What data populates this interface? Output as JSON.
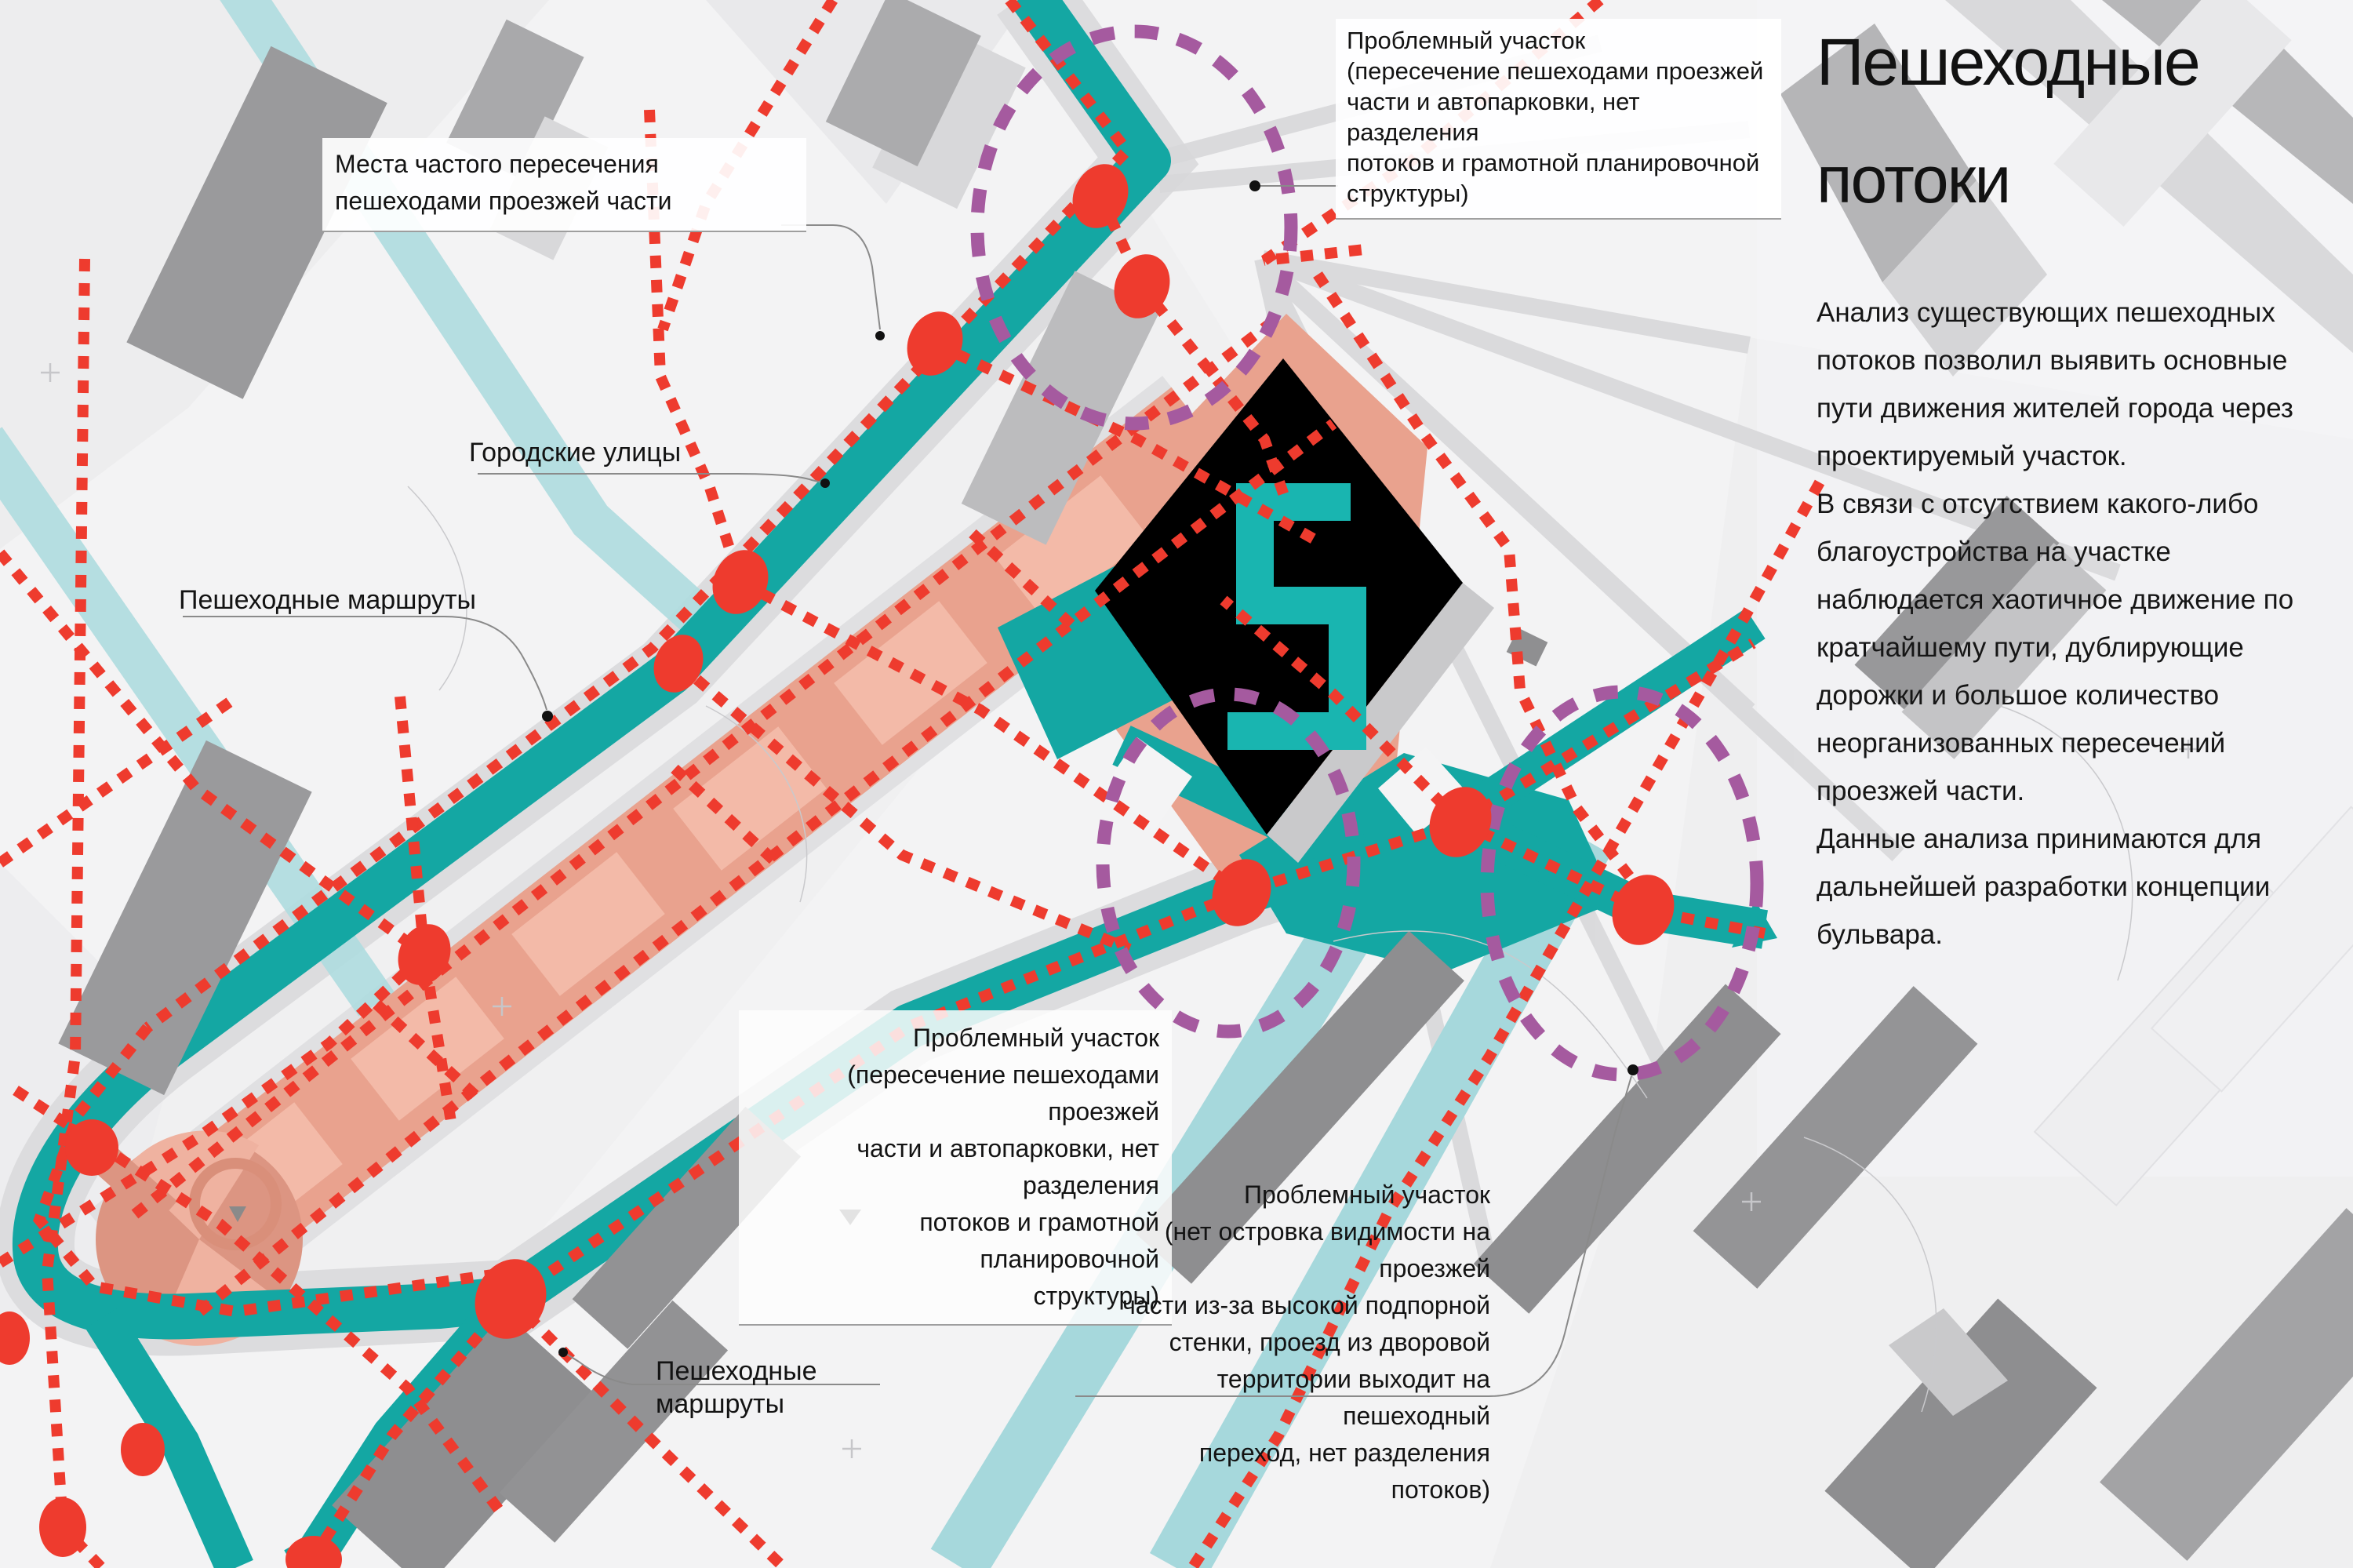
{
  "title": {
    "line1": "Пешеходные",
    "line2": "потоки"
  },
  "description": {
    "para1": "Анализ существующих пешеходных потоков позволил выявить основные пути движения жителей города через проектируемый участок.",
    "para2": "В связи с отсутствием какого-либо благоустройства на участке наблюдается хаотичное движение по кратчайшему пути, дублирующие дорожки и большое количество неорганизованных пересечений проезжей части.",
    "para3": "Данные анализа принимаются для дальнейшей разработки концепции бульвара."
  },
  "map_labels": {
    "frequent_crossings": "Места частого пересечения пешеходами проезжей части",
    "city_streets": "Городские улицы",
    "pedestrian_routes_upper": "Пешеходные маршруты",
    "pedestrian_routes_lower": "Пешеходные маршруты",
    "problem_area_top": "Проблемный участок\n(пересечение пешеходами проезжей\nчасти и автопарковки, нет разделения\nпотоков и грамотной планировочной\nструктуры)",
    "problem_area_middle": "Проблемный участок\n(пересечение пешеходами проезжей\nчасти и автопарковки, нет разделения\nпотоков и грамотной планировочной\nструктуры)",
    "problem_area_bottom": "Проблемный участок\n(нет островка видимости на проезжей\nчасти из-за высокой подпорной\nстенки, проезд из дворовой\nтерритории выходит на пешеходный\nпереход, нет разделения потоков)"
  },
  "legend_colors": {
    "city_street_teal": "#17a8a4",
    "secondary_street_teal": "#a9d8dc",
    "boulevard_salmon": "#e9a28e",
    "pedestrian_route_red": "#ee3b2e",
    "problem_area_purple": "#a55a9f",
    "building_gray": "#9a9a9c",
    "landmark_black": "#000000"
  }
}
